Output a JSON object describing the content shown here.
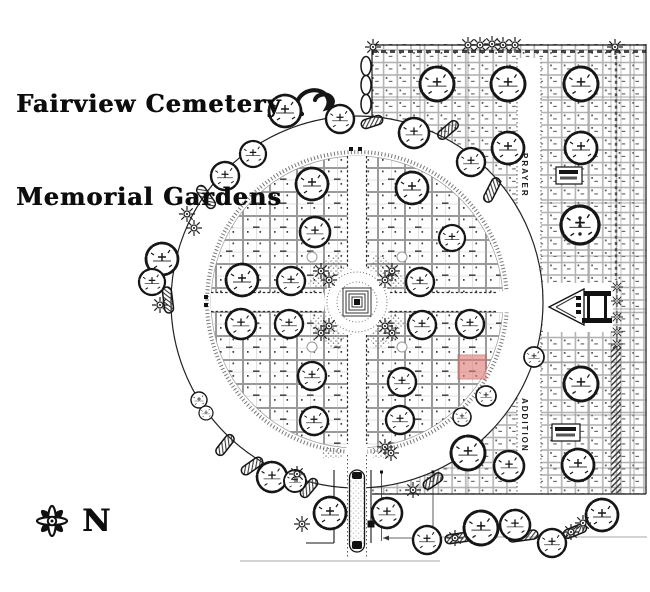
{
  "title": {
    "line1": "Fairview Cemetery",
    "line2": "Memorial Gardens"
  },
  "compass": {
    "label": "N"
  },
  "labels": {
    "road_north": "PRAYER",
    "road_south": "ADDITION"
  },
  "colors": {
    "ink": "#161616",
    "grid": "#8c8c8c",
    "grid_light": "#c4c4c4",
    "paper": "#ffffff",
    "stipple": "#6d6d6d",
    "highlight_fill": "#de7c77",
    "highlight_line": "#b85550"
  },
  "highlight_plot": {
    "x": 458,
    "y": 355,
    "w": 28,
    "h": 24
  },
  "map": {
    "circle": {
      "cx": 357,
      "cy": 302,
      "r_outer": 186,
      "r_hedge": 150,
      "r_inner": 146,
      "r_plaza": 33,
      "road_half": 9.5,
      "beds": [
        [
          20,
          70
        ],
        [
          110,
          160
        ],
        [
          200,
          250
        ],
        [
          290,
          340
        ]
      ],
      "corner_circles": [
        [
          312,
          257
        ],
        [
          402,
          257
        ],
        [
          312,
          347
        ],
        [
          402,
          347
        ]
      ],
      "road_markers": [
        [
          349,
          147
        ],
        [
          358,
          147
        ],
        [
          204,
          295
        ],
        [
          204,
          303
        ]
      ]
    },
    "right_section": {
      "x": 372,
      "y": 44,
      "w": 274,
      "h": 450,
      "road_x": 517,
      "road_w": 24,
      "road_y": 58,
      "strip_x": 611,
      "strip_w": 10,
      "block_cols": [
        420,
        468,
        588,
        634
      ],
      "block_rows": [
        97,
        150,
        203,
        256,
        309,
        362,
        415,
        468
      ]
    },
    "pavilion": {
      "backdrop": [
        543,
        283,
        70,
        49
      ],
      "tri": [
        [
          549,
          307
        ],
        [
          584,
          289
        ],
        [
          584,
          325
        ]
      ],
      "top": [
        584,
        291,
        27,
        5
      ],
      "legs": [
        [
          587,
          296,
          3,
          22
        ],
        [
          604,
          296,
          3,
          22
        ]
      ],
      "base": [
        582,
        318,
        30,
        5
      ],
      "steps": [
        [
          576,
          296,
          5,
          4
        ],
        [
          576,
          303,
          5,
          4
        ],
        [
          576,
          310,
          5,
          4
        ]
      ],
      "road_y": [
        295.5,
        309.5
      ],
      "road_x": [
        498,
        545
      ]
    },
    "sign_boxes": [
      [
        556,
        167,
        26,
        17
      ],
      [
        552,
        424,
        28,
        17
      ]
    ],
    "entrance": {
      "road": [
        347.5,
        446,
        19,
        114
      ],
      "median": [
        349.5,
        470,
        15,
        82
      ],
      "caps": [
        [
          352,
          472,
          10,
          7
        ],
        [
          352,
          541,
          10,
          8
        ]
      ],
      "walls": [
        [
          334,
          470,
          334,
          543
        ],
        [
          371,
          470,
          371,
          543
        ]
      ],
      "corner": [
        306,
        543,
        334,
        543
      ],
      "pillars": [
        [
          330.5,
          520.5
        ],
        [
          367.5,
          520.5
        ]
      ],
      "patches": [
        [
          322,
          448,
          20,
          10
        ],
        [
          372,
          448,
          20,
          10
        ]
      ]
    },
    "dimension": {
      "v": [
        [
          381.5,
          472,
          541
        ],
        [
          433,
          472,
          541
        ]
      ],
      "bar_y": 538,
      "bar_x": [
        383,
        431
      ],
      "ticks": [
        [
          380,
          470.5
        ],
        [
          431.5,
          470.5
        ]
      ]
    },
    "baselines": [
      [
        240,
        561,
        440,
        561
      ],
      [
        430,
        537,
        647,
        537
      ]
    ],
    "trees": [
      [
        437,
        84,
        17
      ],
      [
        508,
        84,
        17
      ],
      [
        581,
        84,
        17
      ],
      [
        414,
        133,
        15
      ],
      [
        508,
        148,
        16
      ],
      [
        581,
        148,
        16
      ],
      [
        580,
        225,
        19
      ],
      [
        581,
        384,
        17
      ],
      [
        468,
        453,
        17
      ],
      [
        509,
        466,
        15
      ],
      [
        578,
        465,
        16
      ],
      [
        285,
        111,
        16
      ],
      [
        340,
        119,
        14
      ],
      [
        253,
        154,
        13
      ],
      [
        225,
        176,
        14
      ],
      [
        162,
        259,
        16
      ],
      [
        152,
        282,
        13
      ],
      [
        199,
        400,
        8
      ],
      [
        206,
        413,
        7
      ],
      [
        272,
        477,
        15
      ],
      [
        295,
        481,
        11
      ],
      [
        330,
        513,
        16
      ],
      [
        387,
        513,
        15
      ],
      [
        427,
        540,
        14
      ],
      [
        486,
        396,
        10
      ],
      [
        534,
        357,
        10
      ],
      [
        481,
        528,
        17
      ],
      [
        515,
        525,
        15
      ],
      [
        552,
        543,
        14
      ],
      [
        602,
        515,
        16
      ],
      [
        312,
        184,
        16
      ],
      [
        315,
        232,
        15
      ],
      [
        242,
        280,
        16
      ],
      [
        291,
        281,
        14
      ],
      [
        412,
        188,
        16
      ],
      [
        471,
        162,
        14
      ],
      [
        452,
        238,
        13
      ],
      [
        420,
        282,
        14
      ],
      [
        422,
        325,
        14
      ],
      [
        470,
        324,
        14
      ],
      [
        402,
        382,
        14
      ],
      [
        400,
        420,
        14
      ],
      [
        462,
        417,
        9
      ],
      [
        241,
        324,
        15
      ],
      [
        289,
        324,
        14
      ],
      [
        312,
        376,
        14
      ],
      [
        314,
        421,
        14
      ]
    ],
    "letter_dots": [
      [
        580,
        218
      ],
      [
        580,
        226
      ],
      [
        580,
        234
      ]
    ],
    "stars": [
      [
        468,
        45
      ],
      [
        480,
        45
      ],
      [
        492,
        44
      ],
      [
        503,
        45
      ],
      [
        515,
        45
      ],
      [
        373,
        47
      ],
      [
        615,
        47
      ],
      [
        187,
        214
      ],
      [
        194,
        228
      ],
      [
        160,
        305
      ],
      [
        321,
        271
      ],
      [
        329,
        280
      ],
      [
        392,
        271
      ],
      [
        385,
        280
      ],
      [
        321,
        333
      ],
      [
        329,
        326
      ],
      [
        392,
        333
      ],
      [
        385,
        326
      ],
      [
        413,
        490
      ],
      [
        297,
        474
      ],
      [
        302,
        524
      ],
      [
        455,
        538
      ],
      [
        571,
        532
      ],
      [
        583,
        523
      ],
      [
        385,
        447
      ],
      [
        391,
        453
      ]
    ],
    "flowers": [
      [
        617,
        287
      ],
      [
        617,
        301
      ],
      [
        617,
        317
      ],
      [
        617,
        332
      ],
      [
        617,
        344
      ]
    ],
    "hedges": [
      [
        206,
        197,
        55,
        26
      ],
      [
        168,
        300,
        83,
        26
      ],
      [
        225,
        445,
        -52,
        24
      ],
      [
        252,
        466,
        -35,
        24
      ],
      [
        309,
        488,
        -50,
        22
      ],
      [
        433,
        481,
        -35,
        22
      ],
      [
        458,
        538,
        -8,
        26
      ],
      [
        523,
        536,
        -8,
        30
      ],
      [
        575,
        531,
        -22,
        24
      ],
      [
        372,
        122,
        -18,
        22
      ],
      [
        448,
        130,
        -40,
        24
      ],
      [
        492,
        190,
        -63,
        26
      ]
    ],
    "ovals": [
      [
        366,
        66
      ],
      [
        366,
        85
      ],
      [
        366,
        104
      ]
    ]
  }
}
